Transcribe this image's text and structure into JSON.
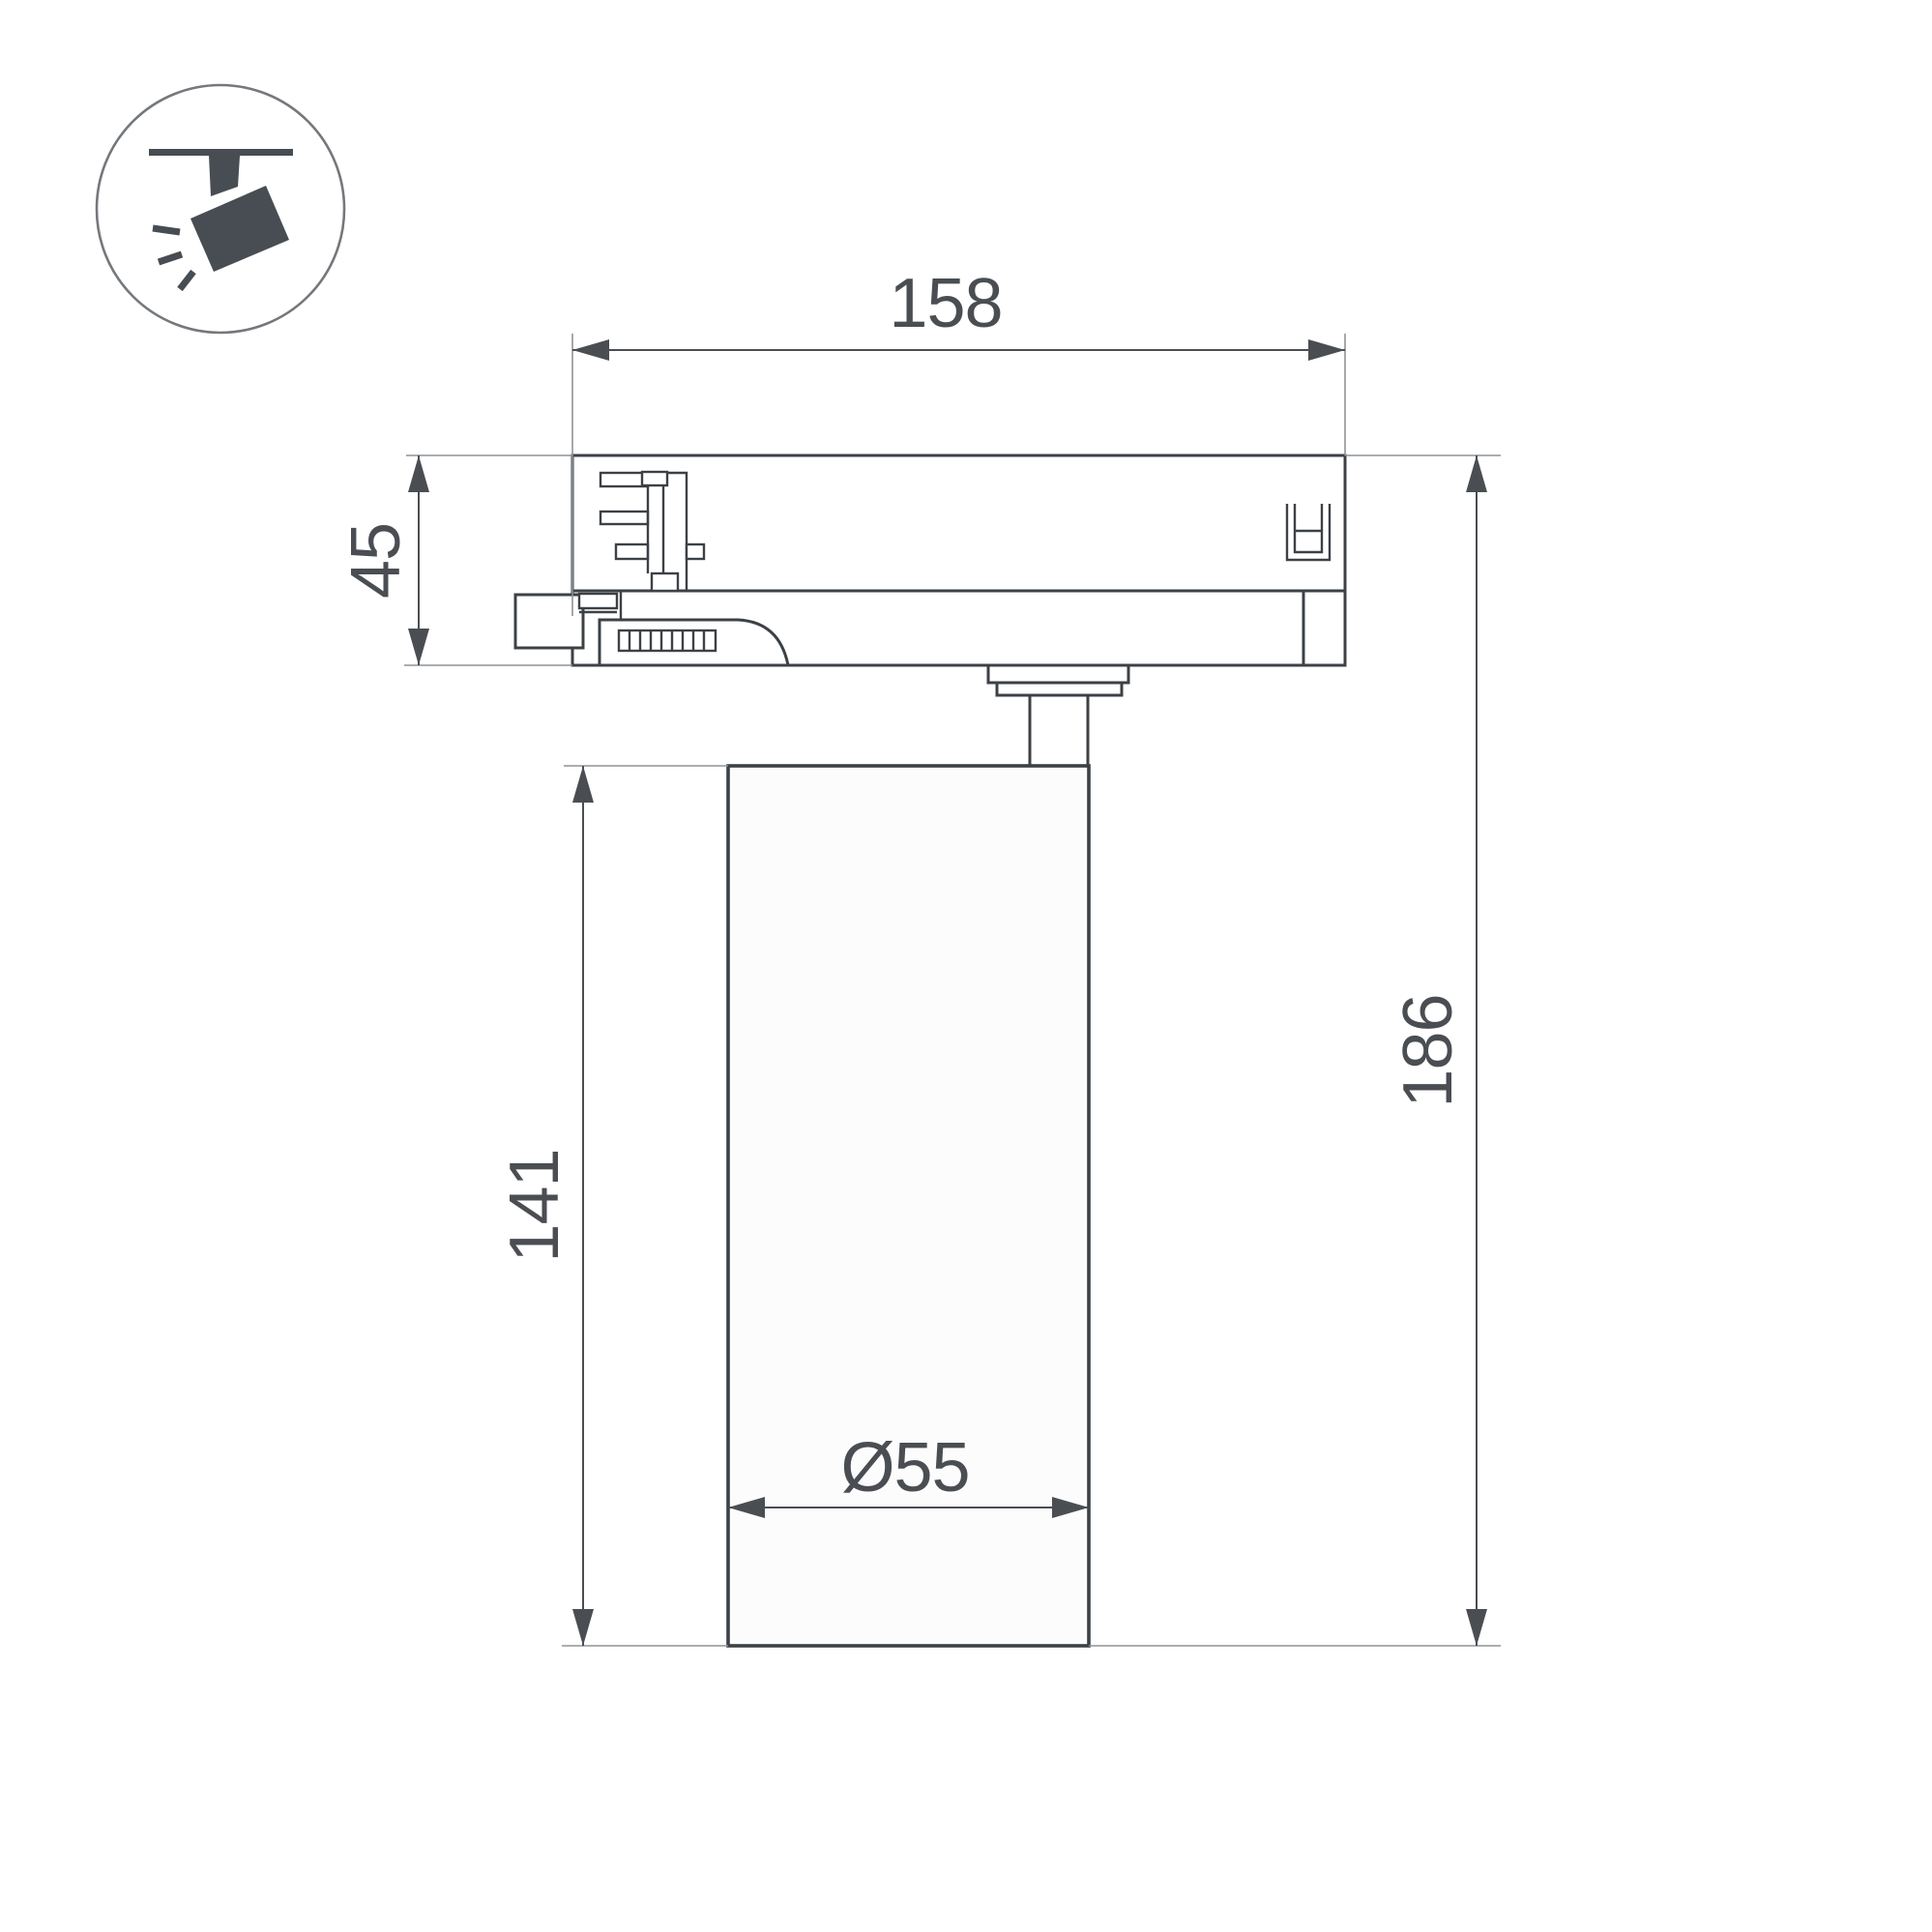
{
  "drawing": {
    "labels": {
      "width_top": "158",
      "adapter_height": "45",
      "body_height": "141",
      "total_height": "186",
      "body_diameter": "Ø55"
    }
  },
  "icon": {
    "name": "track-spotlight-icon"
  },
  "colors": {
    "outline": "#3c4146",
    "dimension": "#4a4e53",
    "extension": "#8f9396",
    "icon": "#474d53",
    "icon-circle": "#74787c",
    "background": "#ffffff",
    "lamp-fill": "#fcfcfd"
  }
}
